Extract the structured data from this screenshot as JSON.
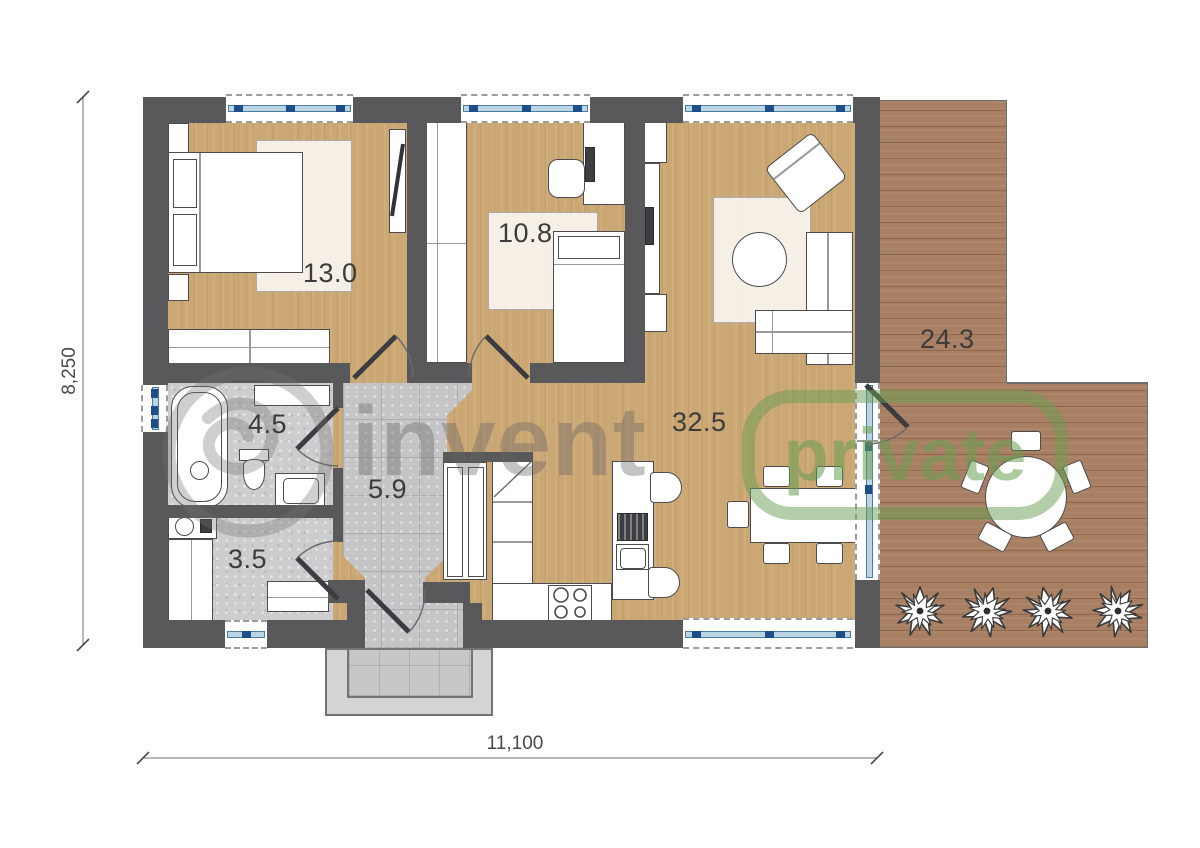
{
  "plan_title": "apartment-floor-plan",
  "rooms": [
    {
      "name": "bedroom",
      "area": "13.0"
    },
    {
      "name": "child-room",
      "area": "10.8"
    },
    {
      "name": "living-kitchen",
      "area": "32.5"
    },
    {
      "name": "terrace",
      "area": "24.3"
    },
    {
      "name": "bathroom",
      "area": "4.5"
    },
    {
      "name": "hallway",
      "area": "5.9"
    },
    {
      "name": "utility-room",
      "area": "3.5"
    }
  ],
  "dimensions": {
    "horizontal": "11,100",
    "vertical": "8,250"
  },
  "watermark": {
    "logo": "circle-swirl-logo",
    "word1": "invent",
    "word2": "private"
  },
  "colors": {
    "wall": "#59595b",
    "wood_floor": "#cba774",
    "terrace_wood": "#a87f62",
    "tile": "#cdcdcf",
    "window_glass": "#b9d4e4",
    "window_tick": "#1d4e89",
    "watermark_gray": "#8a8a8a",
    "watermark_green": "#689e52"
  }
}
